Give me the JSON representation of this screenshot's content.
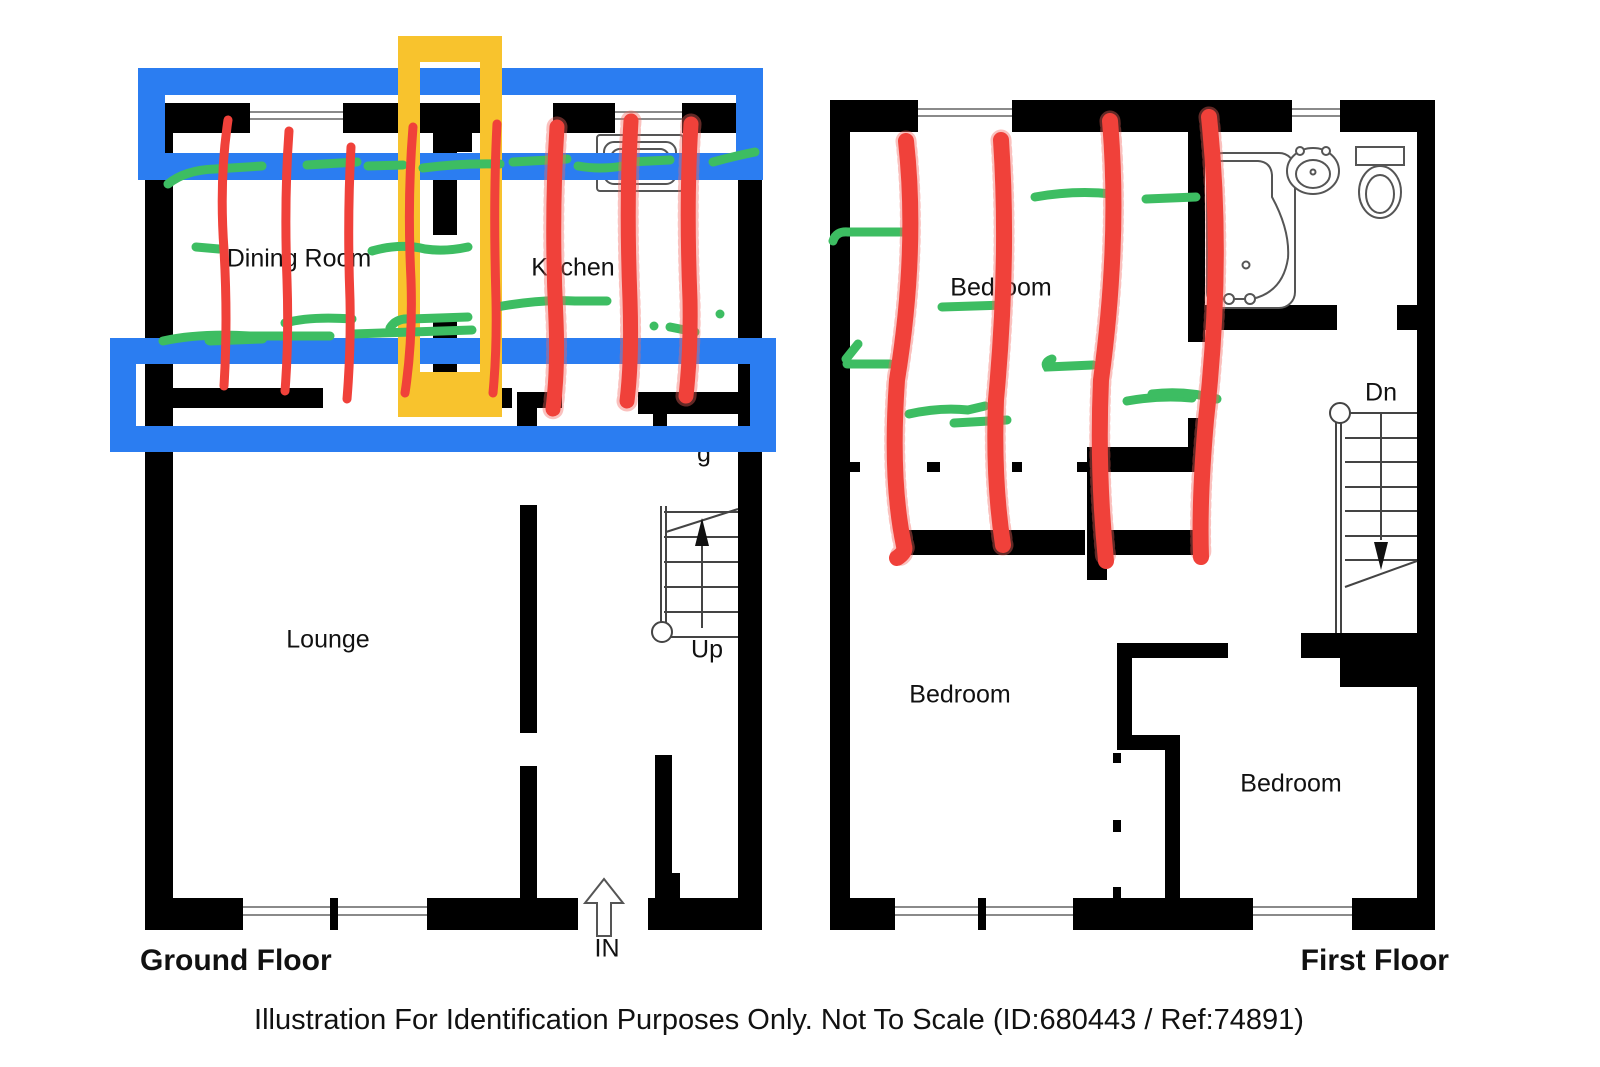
{
  "footer": {
    "disclaimer": "Illustration For Identification Purposes Only. Not To Scale (ID:680443 / Ref:74891)"
  },
  "ground_floor": {
    "title": "Ground Floor",
    "labels": {
      "dining_room": "Dining Room",
      "kitchen": "Kitchen",
      "lounge": "Lounge",
      "stairs": "Up",
      "entrance": "IN",
      "partial_letter": "g"
    }
  },
  "first_floor": {
    "title": "First Floor",
    "labels": {
      "bedroom_top": "Bedroom",
      "bedroom_left": "Bedroom",
      "bedroom_right": "Bedroom",
      "stairs": "Dn"
    }
  },
  "annotations": {
    "colors": {
      "blue": "#2b7df1",
      "yellow": "#f8c32d",
      "red": "#f0413a",
      "red_soft": "#f4675f",
      "green": "#3dbd62",
      "wall": "#000000",
      "fixture": "#555555"
    },
    "highlights": [
      {
        "shape": "rectangle-outline",
        "color": "blue",
        "location": "ground floor top wall"
      },
      {
        "shape": "rectangle-outline",
        "color": "blue",
        "location": "ground floor middle wall"
      },
      {
        "shape": "rectangle-outline",
        "color": "yellow",
        "location": "ground floor centre, vertical"
      },
      {
        "shape": "vertical scribble strokes",
        "color": "red",
        "count": 12,
        "location": "8 over ground floor dining room and kitchen, 4 over first floor bedroom"
      },
      {
        "shape": "horizontal scribble strokes",
        "color": "green",
        "location": "scattered over dining room, kitchen and first floor bedroom / landing"
      }
    ]
  }
}
